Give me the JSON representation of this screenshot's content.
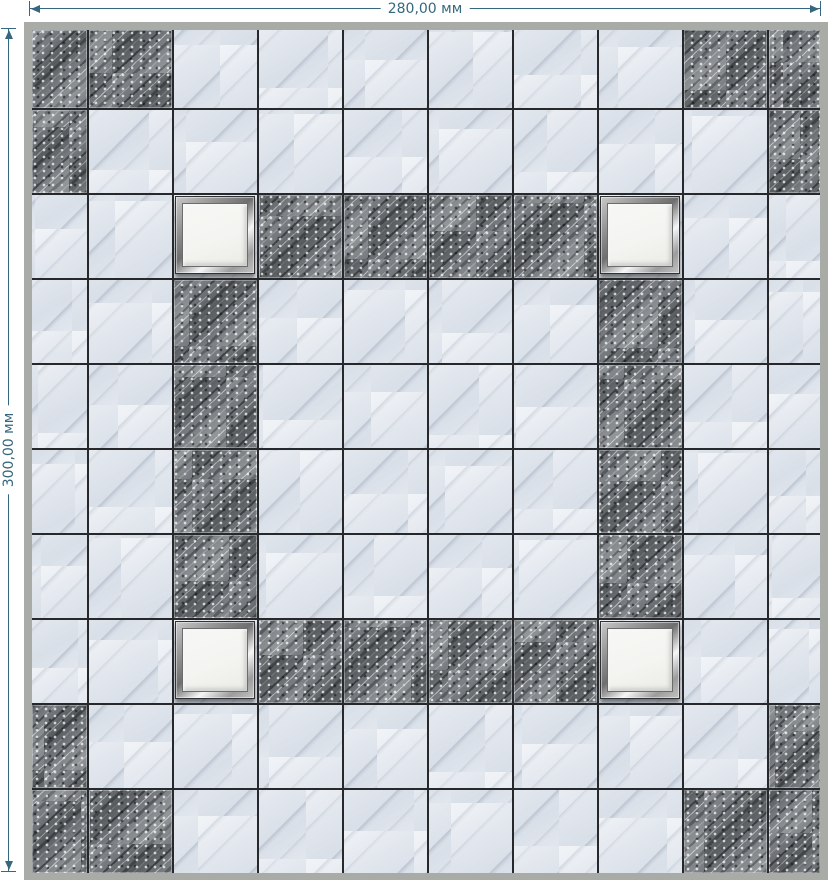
{
  "dimensions": {
    "width_label": "280,00 мм",
    "height_label": "300,00 мм"
  },
  "colors": {
    "dimension_accent": "#35687e",
    "panel_frame_gray": "#a9aba6",
    "grout_line": "#26282b",
    "light_tile_base": "#e2e7ee",
    "dark_tile_base": "#75797d",
    "fixture_panel_white": "#f4f4f1",
    "fixture_frame_silver": "#b9b9b9",
    "background": "#ffffff"
  },
  "grid": {
    "rows": 10,
    "columns": 10,
    "legend": {
      "L": "light-marble-tile",
      "D": "dark-stone-tile",
      "F": "led-light-fixture"
    },
    "pattern": [
      "DDLLLLLLDD",
      "DLLLLLLLLD",
      "LLFDDDDFLL",
      "LLDLLLLDLL",
      "LLDLLLLDLL",
      "LLDLLLLDLL",
      "LLDLLLLDLL",
      "LLFDDDDFLL",
      "DLLLLLLLLD",
      "DDLLLLLLDD"
    ],
    "fixture_count": 4
  }
}
